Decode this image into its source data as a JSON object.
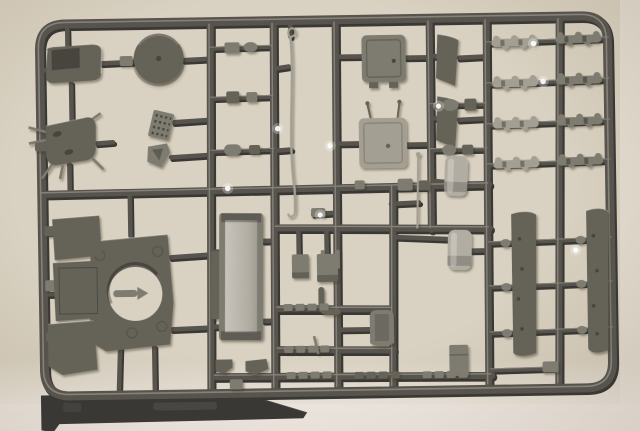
{
  "scene": {
    "subject": "Photograph of an injection-molded plastic model kit sprue with unpainted grey styrene parts on a beige surface",
    "colors": {
      "background": "#d9d1c1",
      "background_light": "#f1eae4",
      "runner": "#57544e",
      "runner_shadow": "#3a3834",
      "runner_highlight": "#979288",
      "part_dark": "#656258",
      "part_darkest": "#46443c",
      "part_mid": "#7e7b70",
      "part_light": "#a49f93",
      "part_metal": "#b2ada2",
      "glint": "#ffffff"
    }
  },
  "parts": {
    "frame": {
      "label": "Sprue frame"
    },
    "runners": {
      "label": "Runner grid"
    },
    "hinged_hatch": {
      "label": "Hinged hatch cover"
    },
    "round_hatch": {
      "label": "Round hatch disc"
    },
    "legged_hatch": {
      "label": "Hatch with hinge pins"
    },
    "grille": {
      "label": "Grille screen"
    },
    "bracket": {
      "label": "Angled bracket"
    },
    "fittings_a": {
      "label": "Small fittings row"
    },
    "fittings_b": {
      "label": "Small fittings row"
    },
    "fittings_c": {
      "label": "Small fittings row"
    },
    "tow_cable": {
      "label": "Tow cable"
    },
    "antenna": {
      "label": "Antenna rod"
    },
    "hatch_a": {
      "label": "Rectangular hatch A"
    },
    "hatch_b": {
      "label": "Rectangular hatch B"
    },
    "mud_flap_a": {
      "label": "Mud flap plate"
    },
    "mud_flap_b": {
      "label": "Mud flap plate"
    },
    "cyl_row_a": {
      "label": "Cylindrical fittings"
    },
    "cyl_row_b": {
      "label": "Cylindrical fittings"
    },
    "track_rows": {
      "label": "Track link clusters"
    },
    "edge_fittings": {
      "label": "Frame edge fittings"
    },
    "u_bracket": {
      "label": "U-shaped bracket"
    },
    "turret_plate": {
      "label": "Roof plate with ring opening"
    },
    "panel_a": {
      "label": "Armor panel"
    },
    "panel_b": {
      "label": "Armor panel"
    },
    "panel_c": {
      "label": "Armor panel"
    },
    "tray": {
      "label": "Stowage tray panel"
    },
    "plate_pair": {
      "label": "Small plate pair"
    },
    "elbow": {
      "label": "Elbow pipe"
    },
    "tank_a": {
      "label": "Fuel tank"
    },
    "tank_b": {
      "label": "Fuel tank"
    },
    "seat_box": {
      "label": "Curved stowage box"
    },
    "small_box": {
      "label": "Small stowage box"
    },
    "fender_left": {
      "label": "Fender side panel"
    },
    "fender_right": {
      "label": "Fender side panel"
    },
    "pad_rows": {
      "label": "Track pad strips"
    },
    "h1_fittings": {
      "label": "Runner mounted fittings"
    },
    "bottom_brackets": {
      "label": "Bottom bracket fittings"
    },
    "tab": {
      "label": "Molding tab"
    },
    "glints": {
      "label": "Light glints on plastic"
    }
  }
}
